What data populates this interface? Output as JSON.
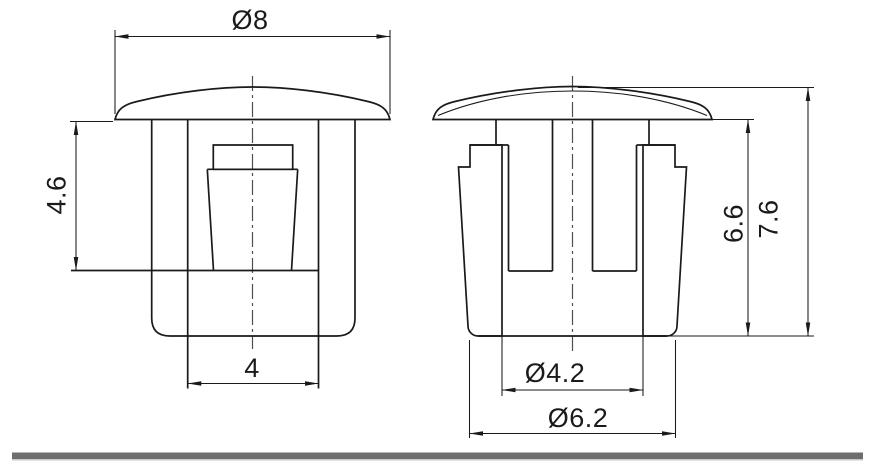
{
  "drawing": {
    "labels": {
      "cap_diameter": "Ø8",
      "head_depth": "4.6",
      "inner_width": "4",
      "inner_height": "6.6",
      "overall_height": "7.6",
      "bore_diameter": "Ø4.2",
      "body_diameter": "Ø6.2"
    },
    "colors": {
      "line": "#1a1a1a",
      "center_line": "#4f4f4f",
      "divider": "#6e6e6e",
      "divider_edge": "#c8c8c8",
      "background": "#ffffff"
    }
  }
}
